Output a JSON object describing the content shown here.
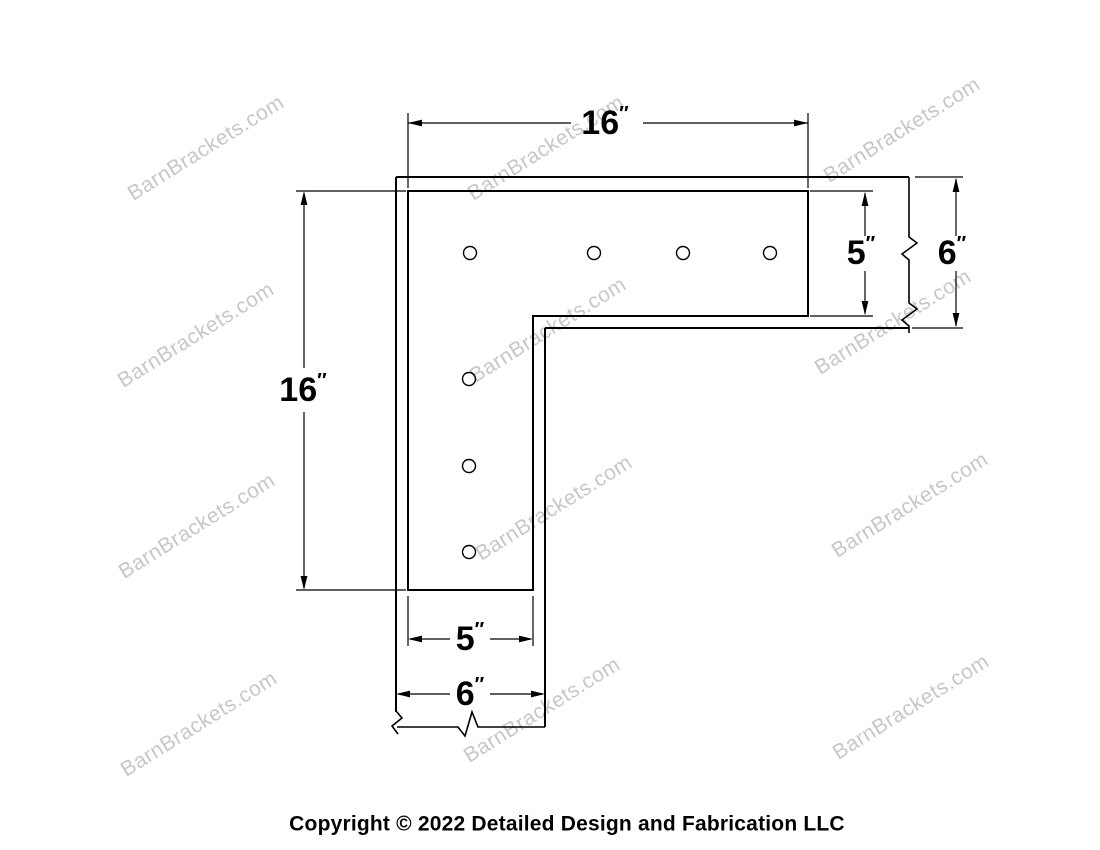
{
  "page": {
    "background": "#ffffff",
    "copyright": "Copyright © 2022 Detailed Design and Fabrication LLC"
  },
  "watermark": {
    "text": "BarnBrackets.com",
    "color": "#c7c7c7"
  },
  "drawing": {
    "type": "technical-dimension-diagram",
    "subject": "L-shaped corner bracket on timber, flush style",
    "units": "inches",
    "line_color": "#000000",
    "dimensions": {
      "top_length": {
        "value": "16",
        "unit": "″"
      },
      "left_length": {
        "value": "16",
        "unit": "″"
      },
      "right_strap_width": {
        "value": "5",
        "unit": "″"
      },
      "right_beam_width": {
        "value": "6",
        "unit": "″"
      },
      "bottom_strap_width": {
        "value": "5",
        "unit": "″"
      },
      "bottom_beam_width": {
        "value": "6",
        "unit": "″"
      }
    },
    "holes": {
      "horizontal_leg": 4,
      "vertical_leg": 3,
      "total": 7
    }
  }
}
